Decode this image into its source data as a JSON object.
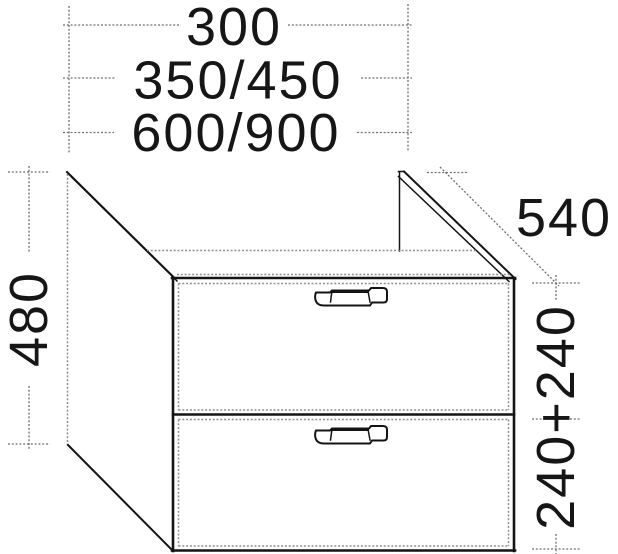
{
  "drawing": {
    "kind": "furniture-dimension-diagram",
    "subject": "two-drawer vanity base unit, isometric line drawing",
    "dimensions": {
      "width_option_1": "300",
      "width_option_2": "350/450",
      "width_option_3": "600/900",
      "height": "480",
      "depth": "540",
      "drawer_heights": "240+240"
    },
    "colors": {
      "background": "#ffffff",
      "outline": "#141414",
      "hidden_edges": "#8d8d8d",
      "dimension_lines": "#6f6f6f",
      "text": "#161616"
    }
  }
}
